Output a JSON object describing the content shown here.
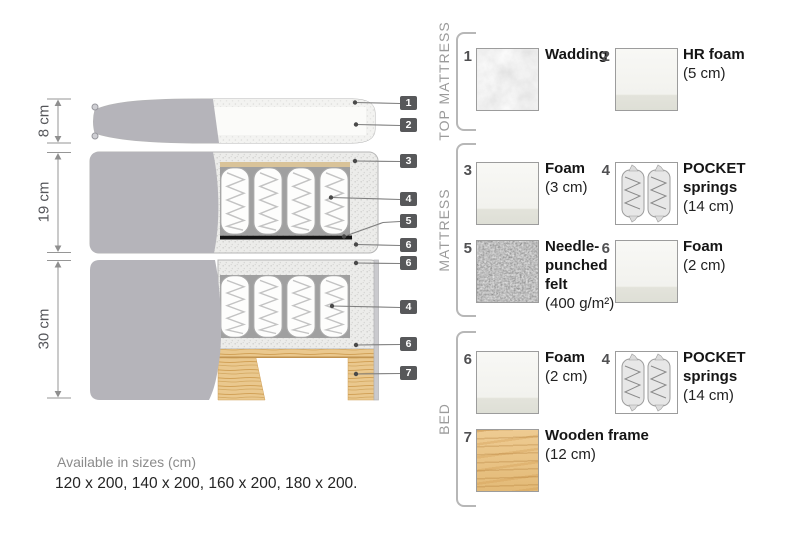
{
  "diagram": {
    "dimensions": [
      {
        "label": "8 cm"
      },
      {
        "label": "19 cm"
      },
      {
        "label": "30 cm"
      }
    ],
    "markers": [
      {
        "number": "1"
      },
      {
        "number": "2"
      },
      {
        "number": "3"
      },
      {
        "number": "4"
      },
      {
        "number": "5"
      },
      {
        "number": "6"
      },
      {
        "number": "6"
      },
      {
        "number": "4"
      },
      {
        "number": "6"
      },
      {
        "number": "7"
      }
    ]
  },
  "legend": {
    "sections": [
      {
        "title": "TOP MATTRESS",
        "items": [
          {
            "number": "1",
            "name": "Wadding",
            "size": "",
            "swatch": "wadding-texture"
          },
          {
            "number": "2",
            "name": "HR foam",
            "size": "(5 cm)",
            "swatch": "foam-texture"
          }
        ]
      },
      {
        "title": "MATTRESS",
        "items": [
          {
            "number": "3",
            "name": "Foam",
            "size": "(3 cm)",
            "swatch": "foam-texture"
          },
          {
            "number": "4",
            "name": "POCKET springs",
            "size": "(14 cm)",
            "swatch": "pocket-springs-texture"
          },
          {
            "number": "5",
            "name": "Needle-punched felt",
            "size": "(400 g/m²)",
            "swatch": "felt-texture"
          },
          {
            "number": "6",
            "name": "Foam",
            "size": "(2 cm)",
            "swatch": "foam-texture"
          }
        ]
      },
      {
        "title": "BED",
        "items": [
          {
            "number": "6",
            "name": "Foam",
            "size": "(2 cm)",
            "swatch": "foam-texture"
          },
          {
            "number": "4",
            "name": "POCKET springs",
            "size": "(14 cm)",
            "swatch": "pocket-springs-texture"
          },
          {
            "number": "7",
            "name": "Wooden frame",
            "size": "(12 cm)",
            "swatch": "wood-texture"
          }
        ]
      }
    ]
  },
  "footer": {
    "sizes_title": "Available in sizes (cm)",
    "sizes_list": "120 x 200, 140 x 200, 160 x 200, 180 x 200."
  },
  "colors": {
    "cover_gray": "#b5b4ba",
    "foam_speckle": "#ececea",
    "felt_black": "#141414",
    "wood": "#eac88e",
    "marker_bg": "#57585a",
    "dimension_text": "#55565a",
    "section_title": "#9b9b9b"
  }
}
